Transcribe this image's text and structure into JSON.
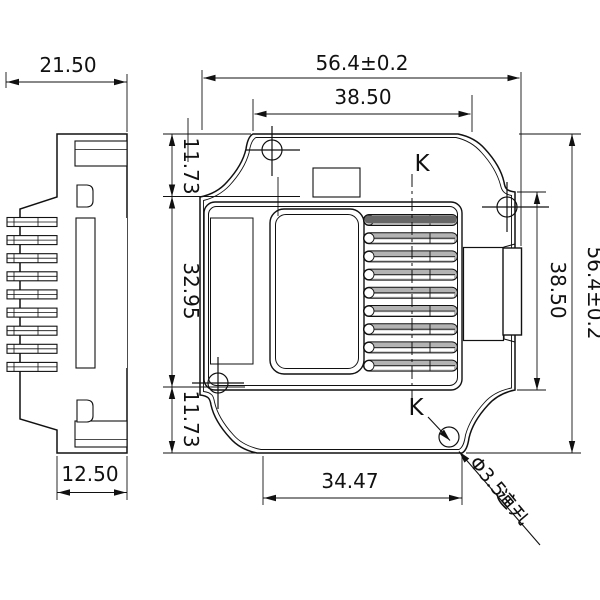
{
  "drawing": {
    "side_view": {
      "dims": {
        "overall_depth": "21.50",
        "housing_depth": "12.50"
      }
    },
    "front_view": {
      "dims": {
        "overall_width": "56.4±0.2",
        "upper_width": "38.50",
        "left_top": "11.73",
        "left_middle": "32.95",
        "left_bottom": "11.73",
        "right_height": "38.50",
        "overall_height": "56.4±0.2",
        "bottom_width": "34.47"
      },
      "section": {
        "top_label": "K",
        "bottom_label": "K"
      },
      "hole_callout": {
        "text": "Φ3.5通孔",
        "latin": "Φ3.5",
        "cjk": "通孔"
      }
    },
    "colors": {
      "line": "#111111",
      "background": "#ffffff",
      "fin_fill": "#b3b3b3"
    }
  }
}
